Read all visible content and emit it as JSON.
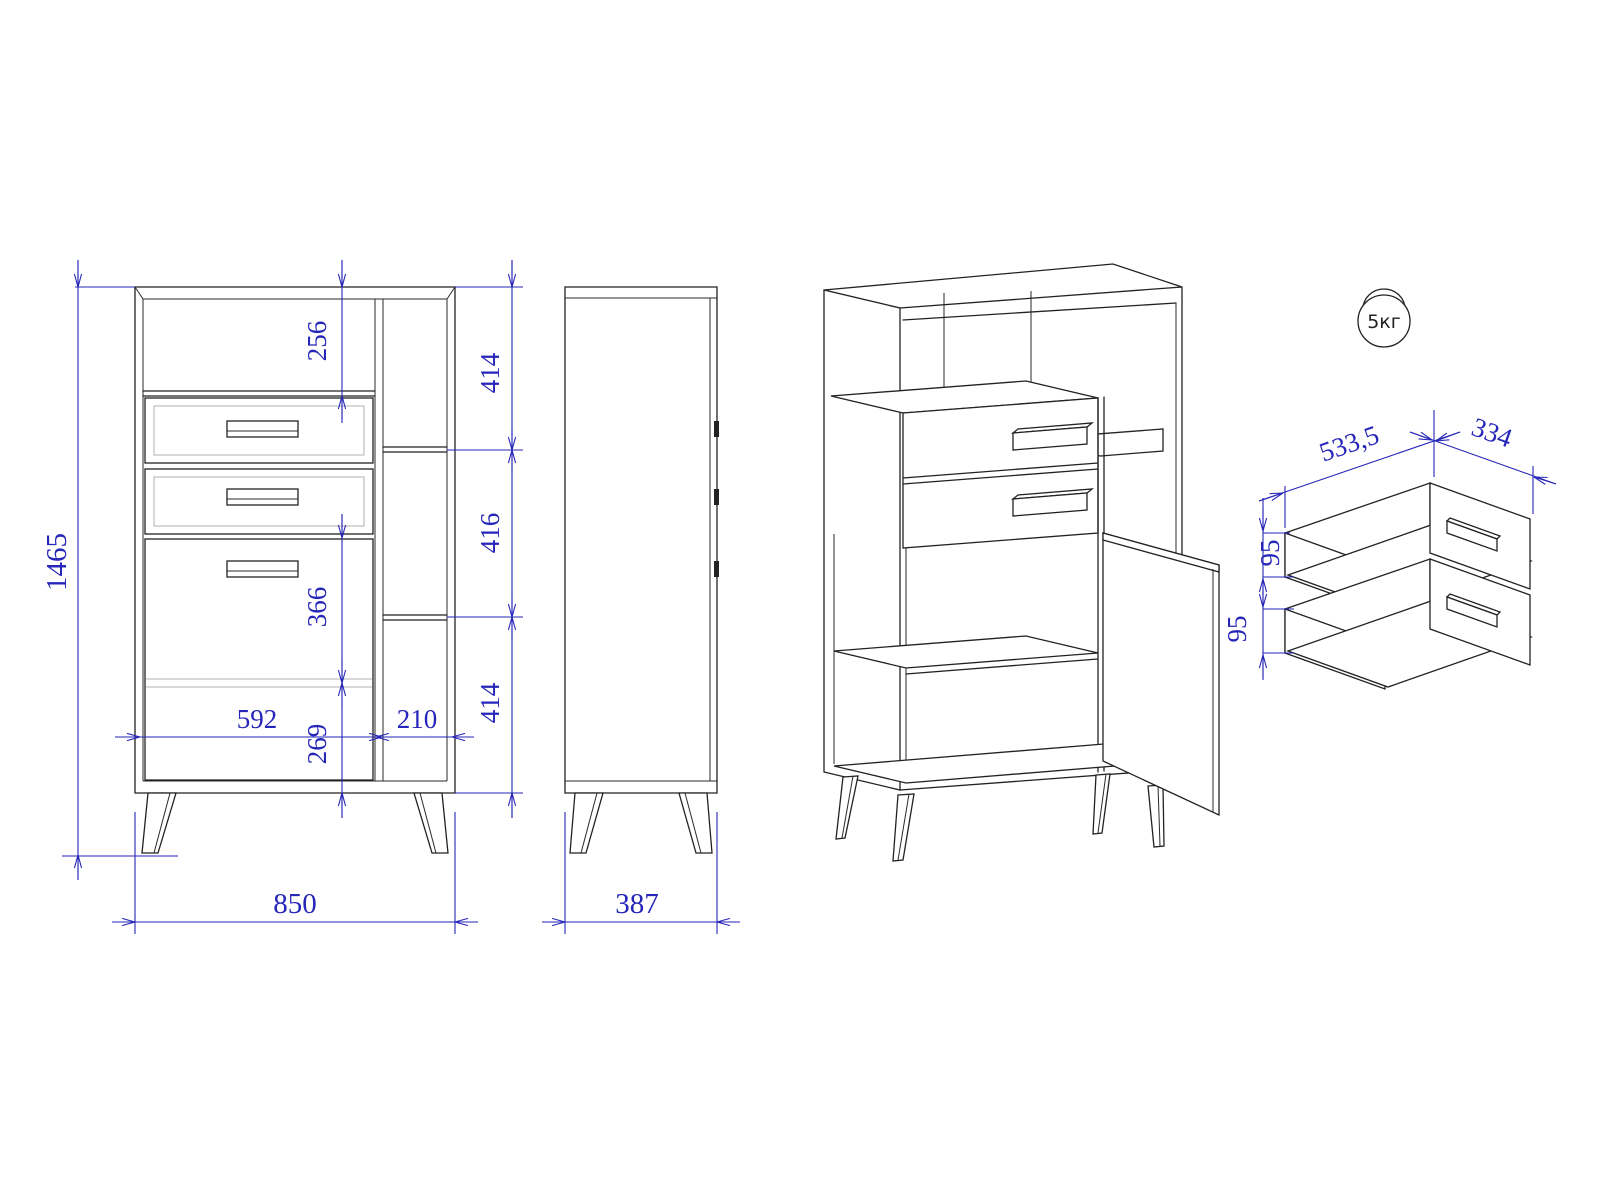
{
  "drawing": {
    "front_view": {
      "total_height": "1465",
      "total_width": "850",
      "top_offset": "256",
      "shelf_top": "414",
      "shelf_middle": "416",
      "shelf_bottom": "414",
      "door_upper": "366",
      "door_lower": "269",
      "left_section_width": "592",
      "right_section_width": "210"
    },
    "side_view": {
      "depth": "387"
    },
    "drawer_detail": {
      "width": "533,5",
      "depth": "334",
      "drawer1_side_height": "95",
      "drawer2_side_height": "95"
    },
    "load_limit": {
      "label": "5кг"
    },
    "colors": {
      "dimension": "#2626b8",
      "line": "#222222"
    }
  }
}
